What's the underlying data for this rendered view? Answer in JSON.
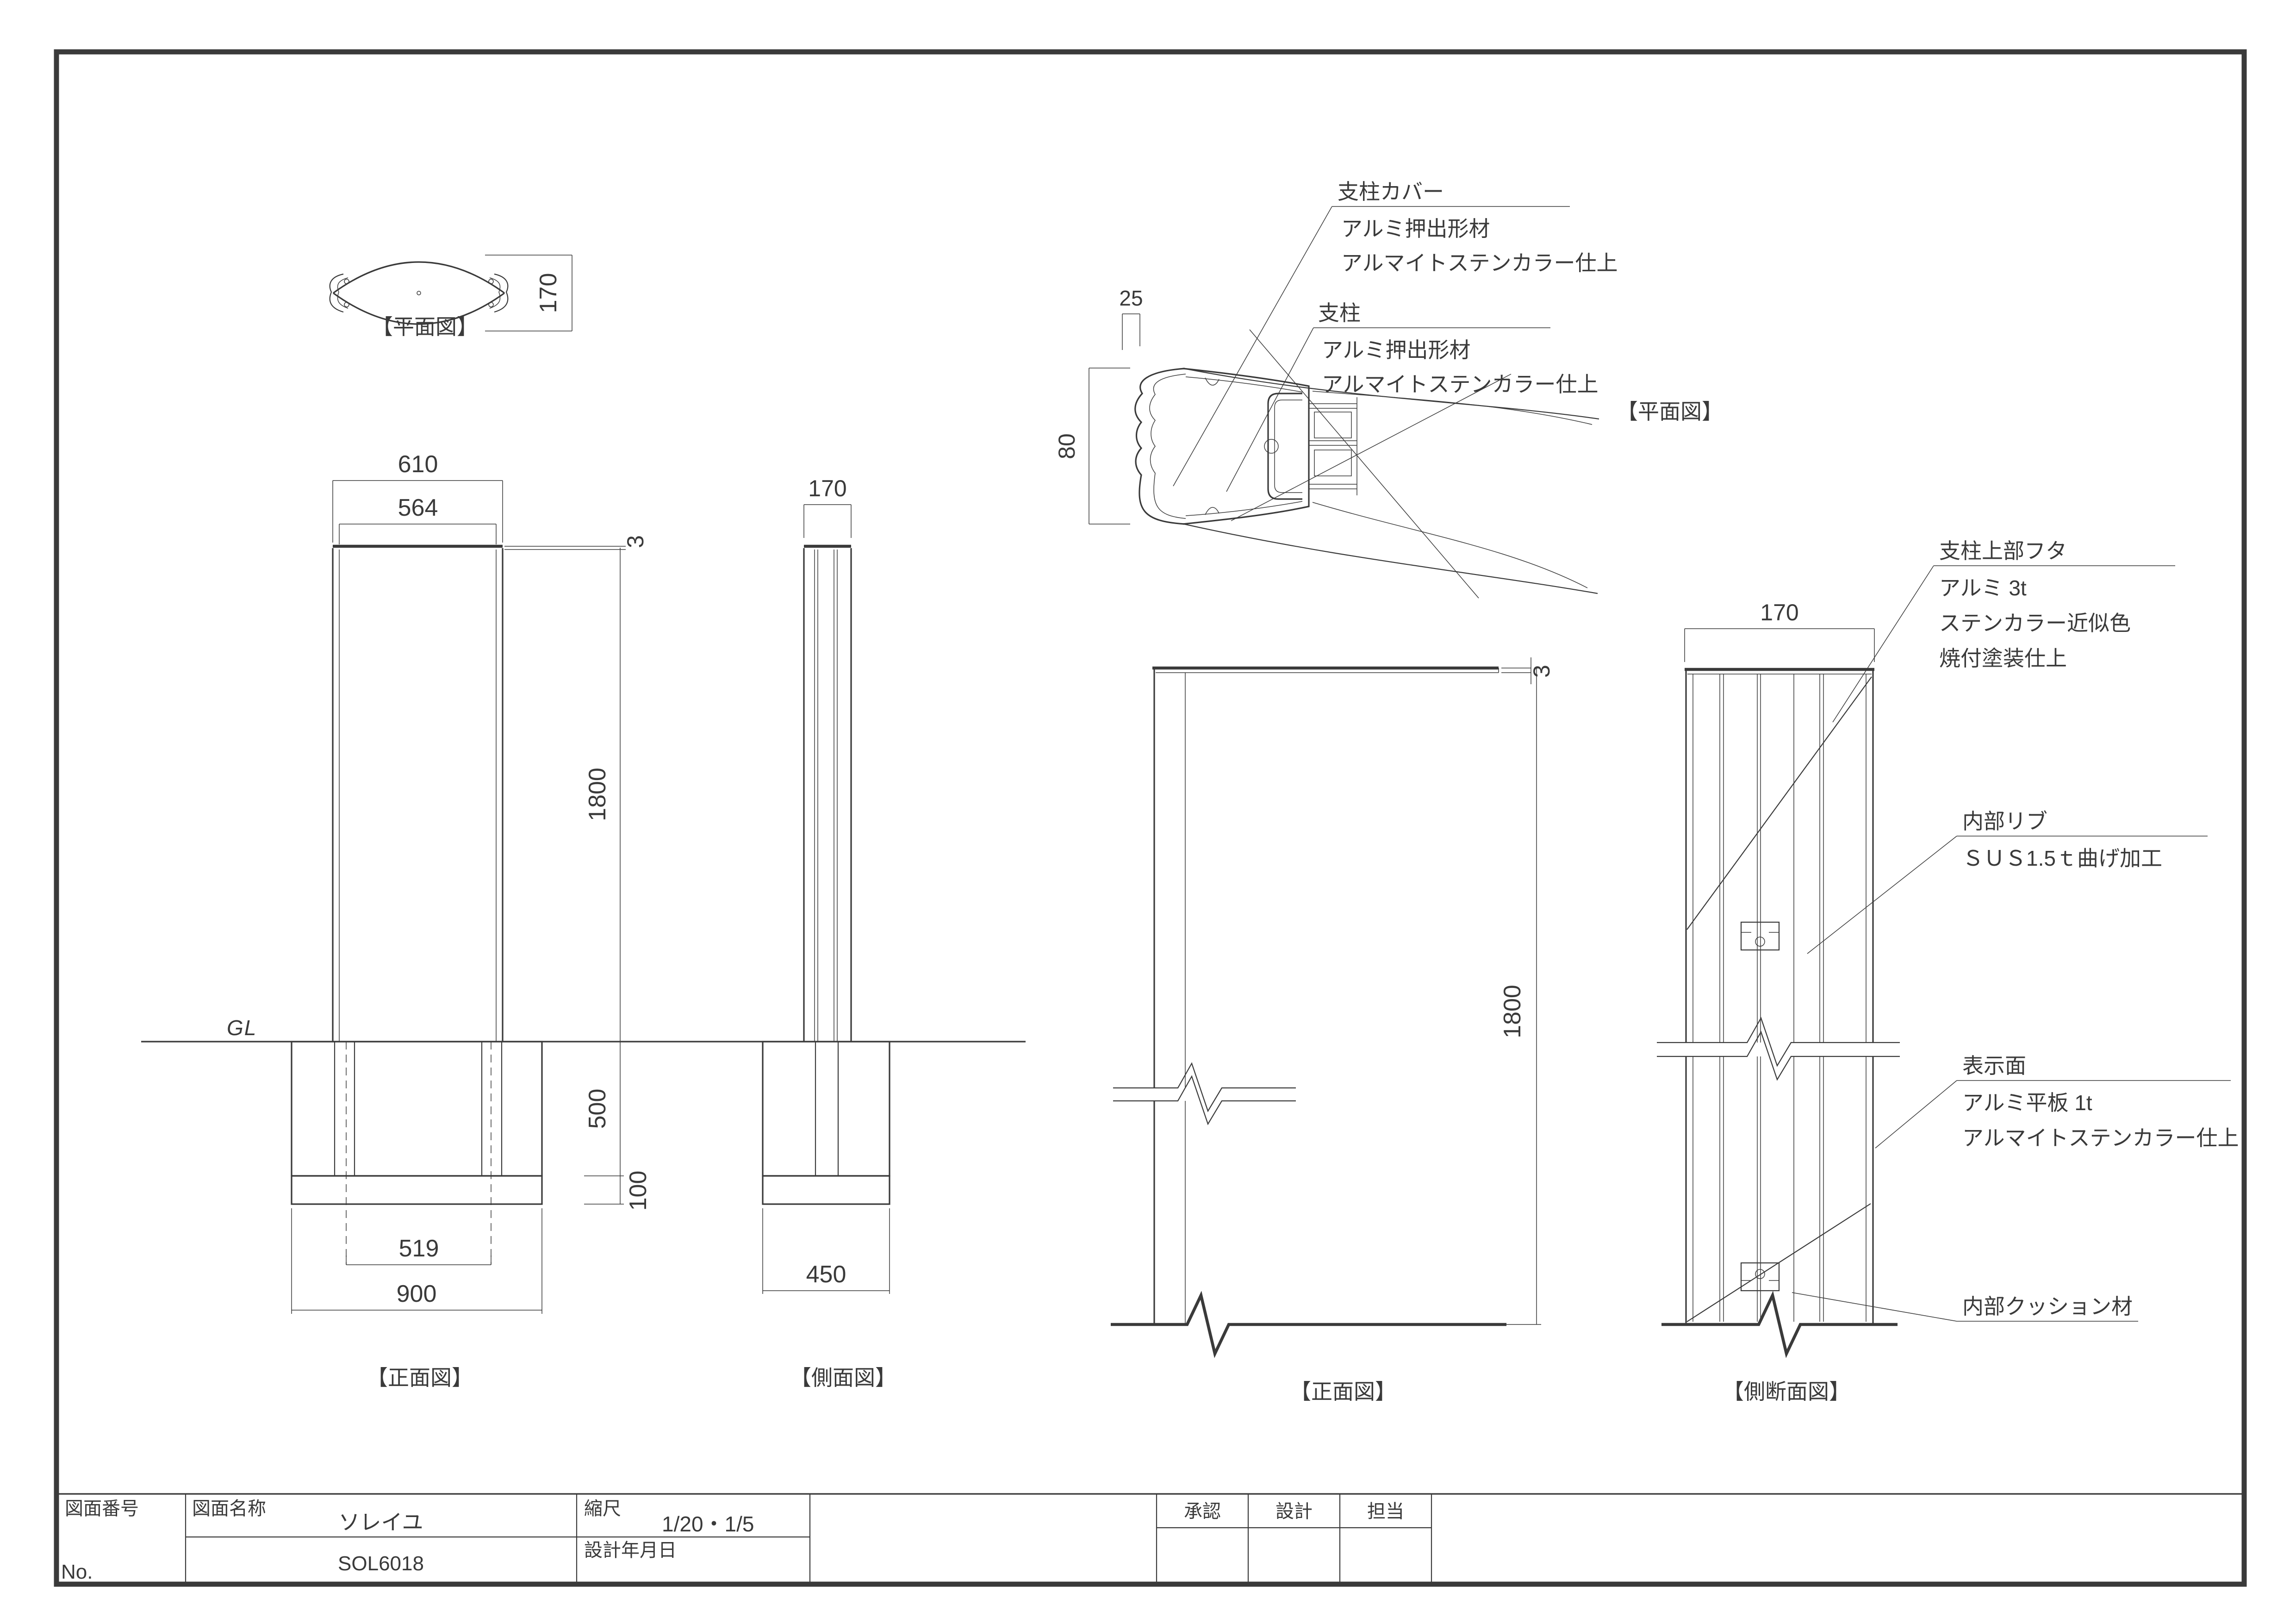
{
  "labels": {
    "plan_left": "【平面図】",
    "front_left": "【正面図】",
    "side_left": "【側面図】",
    "plan_right": "【平面図】",
    "front_right": "【正面図】",
    "section_right": "【側断面図】",
    "gl": "GL"
  },
  "dims": {
    "plan_height": "170",
    "front_width": "610",
    "front_inner_width": "564",
    "cap_thickness": "3",
    "body_height": "1800",
    "foundation_depth": "500",
    "gravel_thickness": "100",
    "post_centers": "519",
    "foundation_width": "900",
    "side_width": "170",
    "side_foundation_width": "450",
    "detail_cover_width": "25",
    "detail_post_depth": "80",
    "right_cap_thickness": "3",
    "right_body_height": "1800",
    "section_width": "170"
  },
  "callouts": {
    "cover": {
      "lines": [
        "支柱カバー",
        "アルミ押出形材",
        "アルマイトステンカラー仕上"
      ]
    },
    "post": {
      "lines": [
        "支柱",
        "アルミ押出形材",
        "アルマイトステンカラー仕上"
      ]
    },
    "cap": {
      "lines": [
        "支柱上部フタ",
        "アルミ 3t",
        "ステンカラー近似色",
        "焼付塗装仕上"
      ]
    },
    "rib": {
      "lines": [
        "内部リブ",
        "ＳＵＳ1.5ｔ曲げ加工"
      ]
    },
    "face": {
      "lines": [
        "表示面",
        "アルミ平板 1t",
        "アルマイトステンカラー仕上"
      ]
    },
    "cushion": {
      "lines": [
        "内部クッション材"
      ]
    }
  },
  "title_block": {
    "number_label": "図面番号",
    "no_label": "No.",
    "name_label": "図面名称",
    "name": "ソレイユ",
    "code": "SOL6018",
    "scale_label": "縮尺",
    "scale": "1/20・1/5",
    "date_label": "設計年月日",
    "approve": "承認",
    "design": "設計",
    "charge": "担当"
  }
}
